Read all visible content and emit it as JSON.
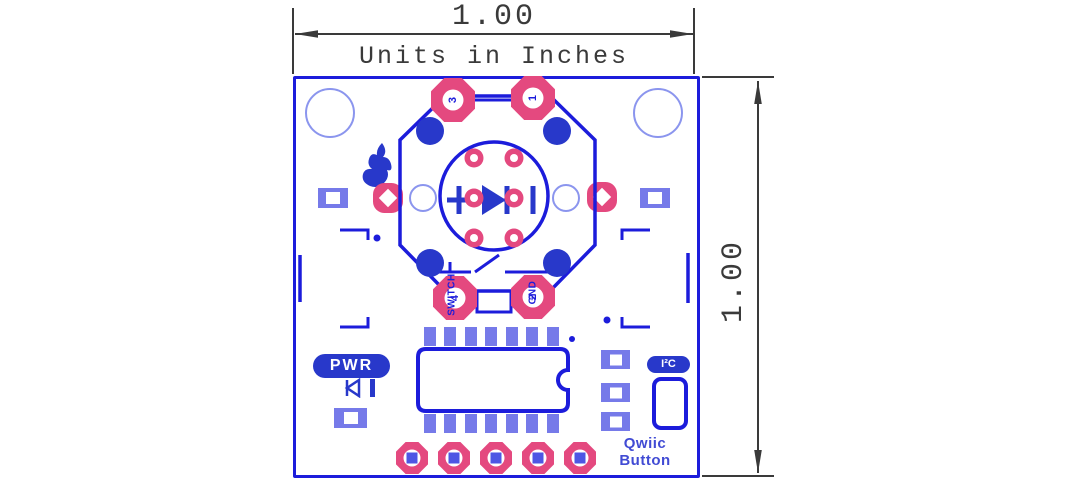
{
  "annotations": {
    "top_width": "1.00",
    "right_height": "1.00",
    "units_note": "Units in Inches"
  },
  "pcb": {
    "labels": {
      "pwr": "PWR",
      "i2c": "I²C",
      "product_line1": "Qwiic",
      "product_line2": "Button"
    },
    "button": {
      "pad3": "3",
      "pad1": "1",
      "pad4": "4",
      "pad2": "2",
      "net_switch": "SWITCH",
      "net_gnd": "GND"
    }
  },
  "colors": {
    "silkscreen_blue": "#1c1cdb",
    "fill_blue": "#2838ca",
    "pad_periwinkle": "#767ae9",
    "pad_square_blue": "#4e56e4",
    "drill_pink": "#e4497f",
    "hole_outline_blue": "#8b95ee",
    "dimension_gray": "#3a3a3a",
    "background": "#ffffff"
  }
}
